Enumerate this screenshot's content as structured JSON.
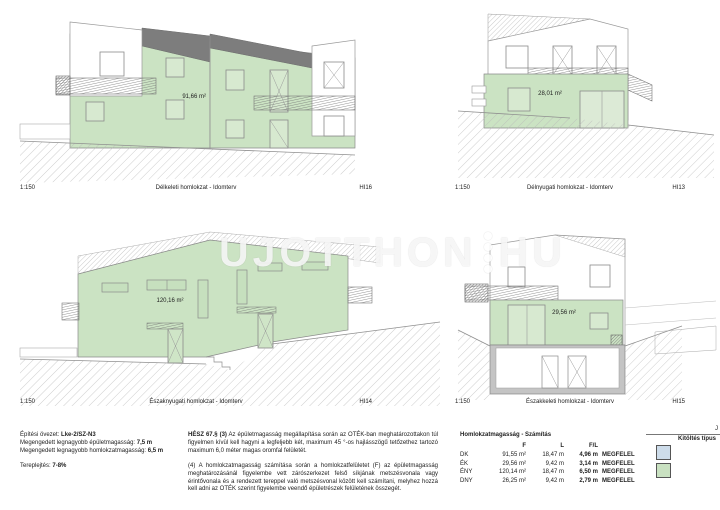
{
  "watermark": {
    "left": "UJOTTHON",
    "right": "HU"
  },
  "views": {
    "southeast": {
      "scale": "1:150",
      "caption": "Délkeleti homlokzat - Idomterv",
      "code": "HI16",
      "area": "91,66 m²"
    },
    "southwest": {
      "scale": "1:150",
      "caption": "Délnyugati homlokzat - Idomterv",
      "code": "HI13",
      "area": "28,01 m²"
    },
    "northwest": {
      "scale": "1:150",
      "caption": "Északnyugati homlokzat - Idomterv",
      "code": "HI14",
      "area": "120,16 m²"
    },
    "northeast": {
      "scale": "1:150",
      "caption": "Északkeleti homlokzat - Idomterv",
      "code": "HI15",
      "area": "29,56 m²"
    }
  },
  "notes": {
    "zoning_label": "Építési övezet:",
    "zoning_value": "Lke-2/SZ-N3",
    "building_height_label": "Megengedett legnagyobb épületmagasság:",
    "building_height_value": "7,5 m",
    "facade_height_label": "Megengedett legnagyobb homlokzatmagasság:",
    "facade_height_value": "6,5 m",
    "slope_label": "Tereplejtés:",
    "slope_value": "7-8%"
  },
  "regulation": {
    "para1_lead": "HÉSZ 67.§ (3)",
    "para1": " Az épületmagasság megállapítása során az OTÉK-ban meghatározottakon túl figyelmen kívül kell  hagyni a legfeljebb két, maximum 45 °-os hajlásszögű tetőzethez tartozó maximum 6,0 méter magas oromfal felületét.",
    "para2": "(4) A homlokzatmagasság számítása során a homlokzatfelületet (F) az épületmagasság meghatározásánál figyelembe vett zárószerkezet felső síkjának metszésvonala vagy érintővonala és a rendezett tereppel való metszésvonal között kell számítani, melyhez hozzá kell adni az OTÉK szerint figyelembe veendő épületrészek felületének összegét."
  },
  "calc_table": {
    "title": "Homlokzatmagasság - Számítás",
    "col_f": "F",
    "col_l": "L",
    "col_fl": "F/L",
    "rows": [
      {
        "dir": "DK",
        "f": "91,55 m²",
        "l": "18,47 m",
        "fl": "4,96 m",
        "result": "MEGFELEL"
      },
      {
        "dir": "ÉK",
        "f": "29,56 m²",
        "l": "9,42 m",
        "fl": "3,14 m",
        "result": "MEGFELEL"
      },
      {
        "dir": "ÉNY",
        "f": "120,14 m²",
        "l": "18,47 m",
        "fl": "6,50 m",
        "result": "MEGFELEL"
      },
      {
        "dir": "DNY",
        "f": "26,25 m²",
        "l": "9,42 m",
        "fl": "2,79 m",
        "result": "MEGFELEL"
      }
    ]
  },
  "legend": {
    "partial": "J",
    "title": "Kitöltés típus",
    "swatch_blue": "#cddcea",
    "swatch_green": "#c9e1c1"
  },
  "colors": {
    "facade_green": "#cbe3c3",
    "roof_gray": "#7d7d7d"
  }
}
